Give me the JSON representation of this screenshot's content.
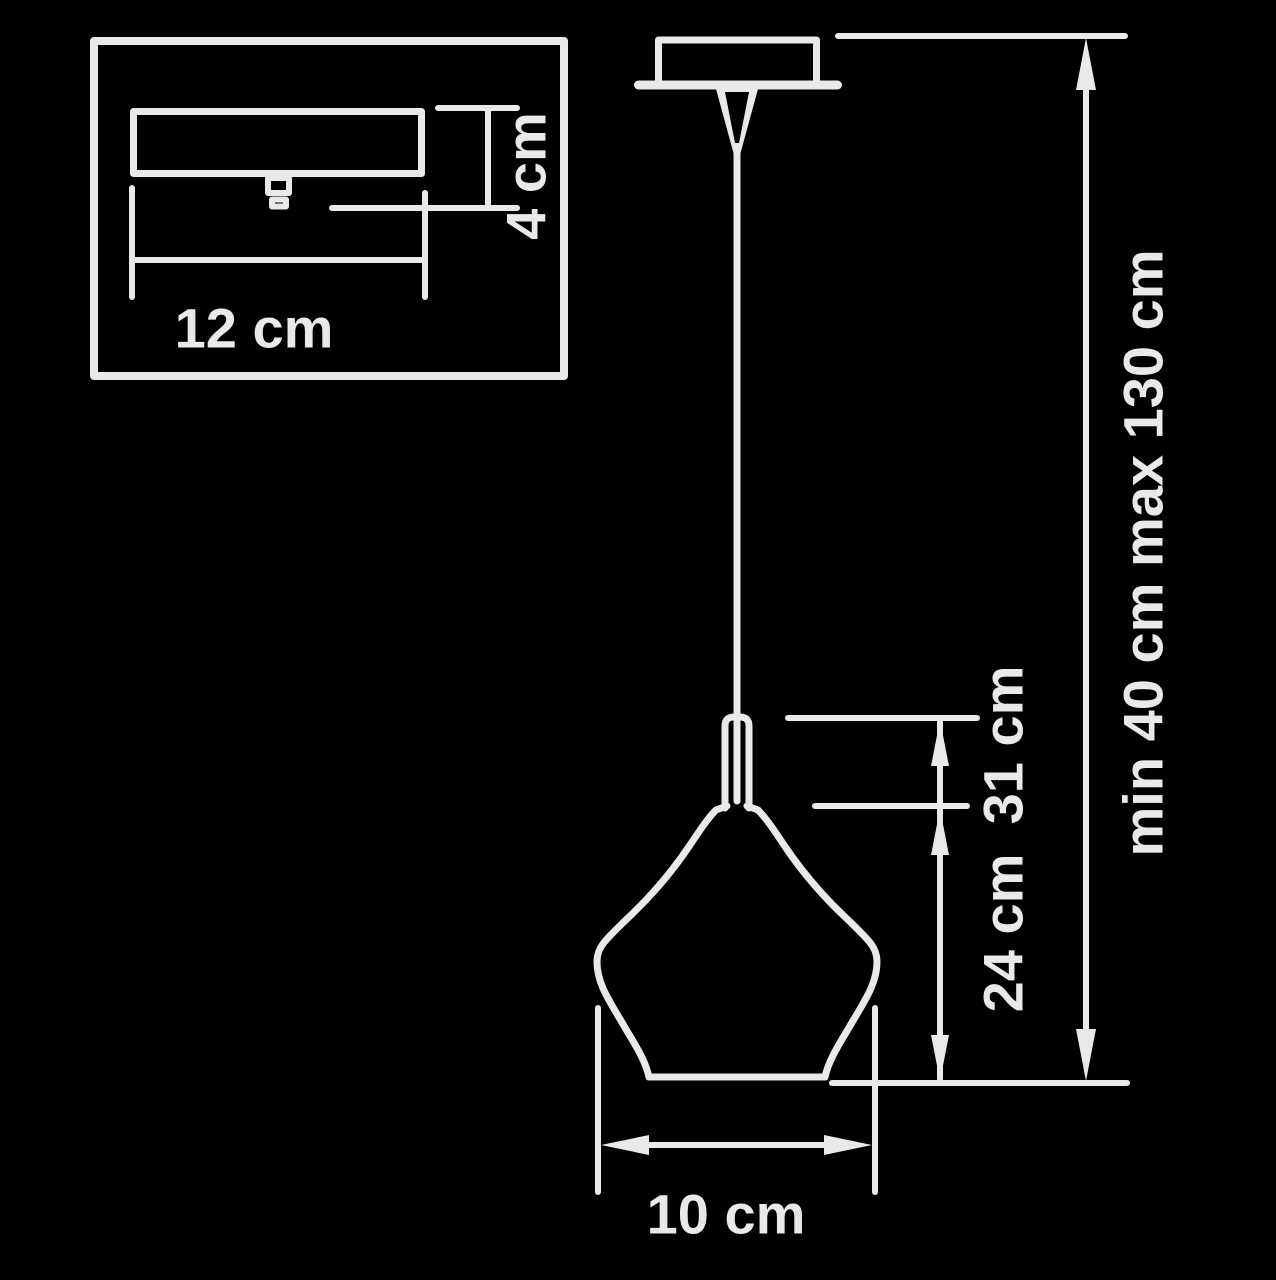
{
  "diagram": {
    "kind": "pendant-lamp-dimension-drawing",
    "colors": {
      "background": "#000000",
      "line": "#e9e9e9"
    },
    "labels": {
      "canopy_width": "12 cm",
      "canopy_height": "4 cm",
      "fixture_height": "31 cm",
      "shade_height": "24 cm",
      "shade_diameter": "10 cm",
      "suspension_range": "min 40 cm max 130 cm"
    }
  }
}
